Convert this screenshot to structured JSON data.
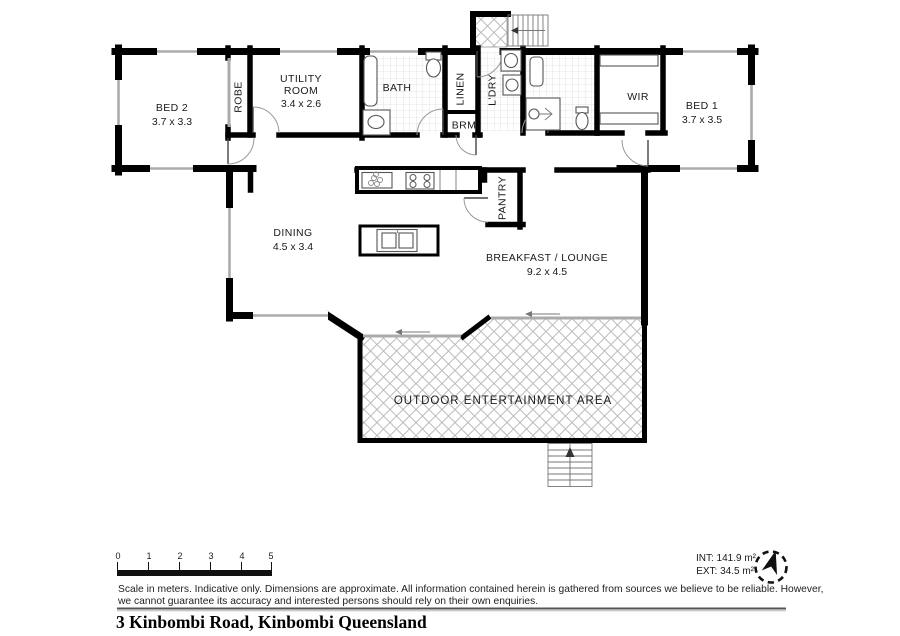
{
  "rooms": {
    "bed2": {
      "name": "BED 2",
      "dims": "3.7 x 3.3"
    },
    "robe": {
      "name": "ROBE"
    },
    "utility": {
      "line1": "UTILITY",
      "line2": "ROOM",
      "dims": "3.4 x 2.6"
    },
    "bath": {
      "name": "BATH"
    },
    "linen": {
      "name": "LINEN"
    },
    "brm": {
      "name": "BRM"
    },
    "ldry": {
      "name": "L'DRY"
    },
    "wir": {
      "name": "WIR"
    },
    "bed1": {
      "name": "BED 1",
      "dims": "3.7 x 3.5"
    },
    "dining": {
      "name": "DINING",
      "dims": "4.5 x 3.4"
    },
    "breakfast": {
      "name": "BREAKFAST / LOUNGE",
      "dims": "9.2 x 4.5"
    },
    "pantry": {
      "name": "PANTRY"
    },
    "outdoor": {
      "name": "OUTDOOR ENTERTAINMENT AREA"
    }
  },
  "scale_bar": {
    "labels": [
      "0",
      "1",
      "2",
      "3",
      "4",
      "5"
    ]
  },
  "areas": {
    "int": "INT: 141.9 m²",
    "ext": "EXT: 34.5 m²"
  },
  "disclaimer": {
    "line1": "Scale in meters. Indicative only. Dimensions are approximate. All information contained herein is gathered from sources we believe to be reliable. However,",
    "line2": "we cannot guarantee its accuracy and interested persons should rely on their own enquiries."
  },
  "footer": {
    "title": "3 Kinbombi Road, Kinbombi Queensland"
  },
  "icons": {
    "compass": "north-arrow-compass",
    "stairs_top": "arrow-left",
    "stairs_bottom": "arrow-up"
  },
  "colors": {
    "wall": "#000000",
    "window": "#ababab",
    "paving": "#b8b8b8",
    "tile": "#d9d9d9"
  }
}
